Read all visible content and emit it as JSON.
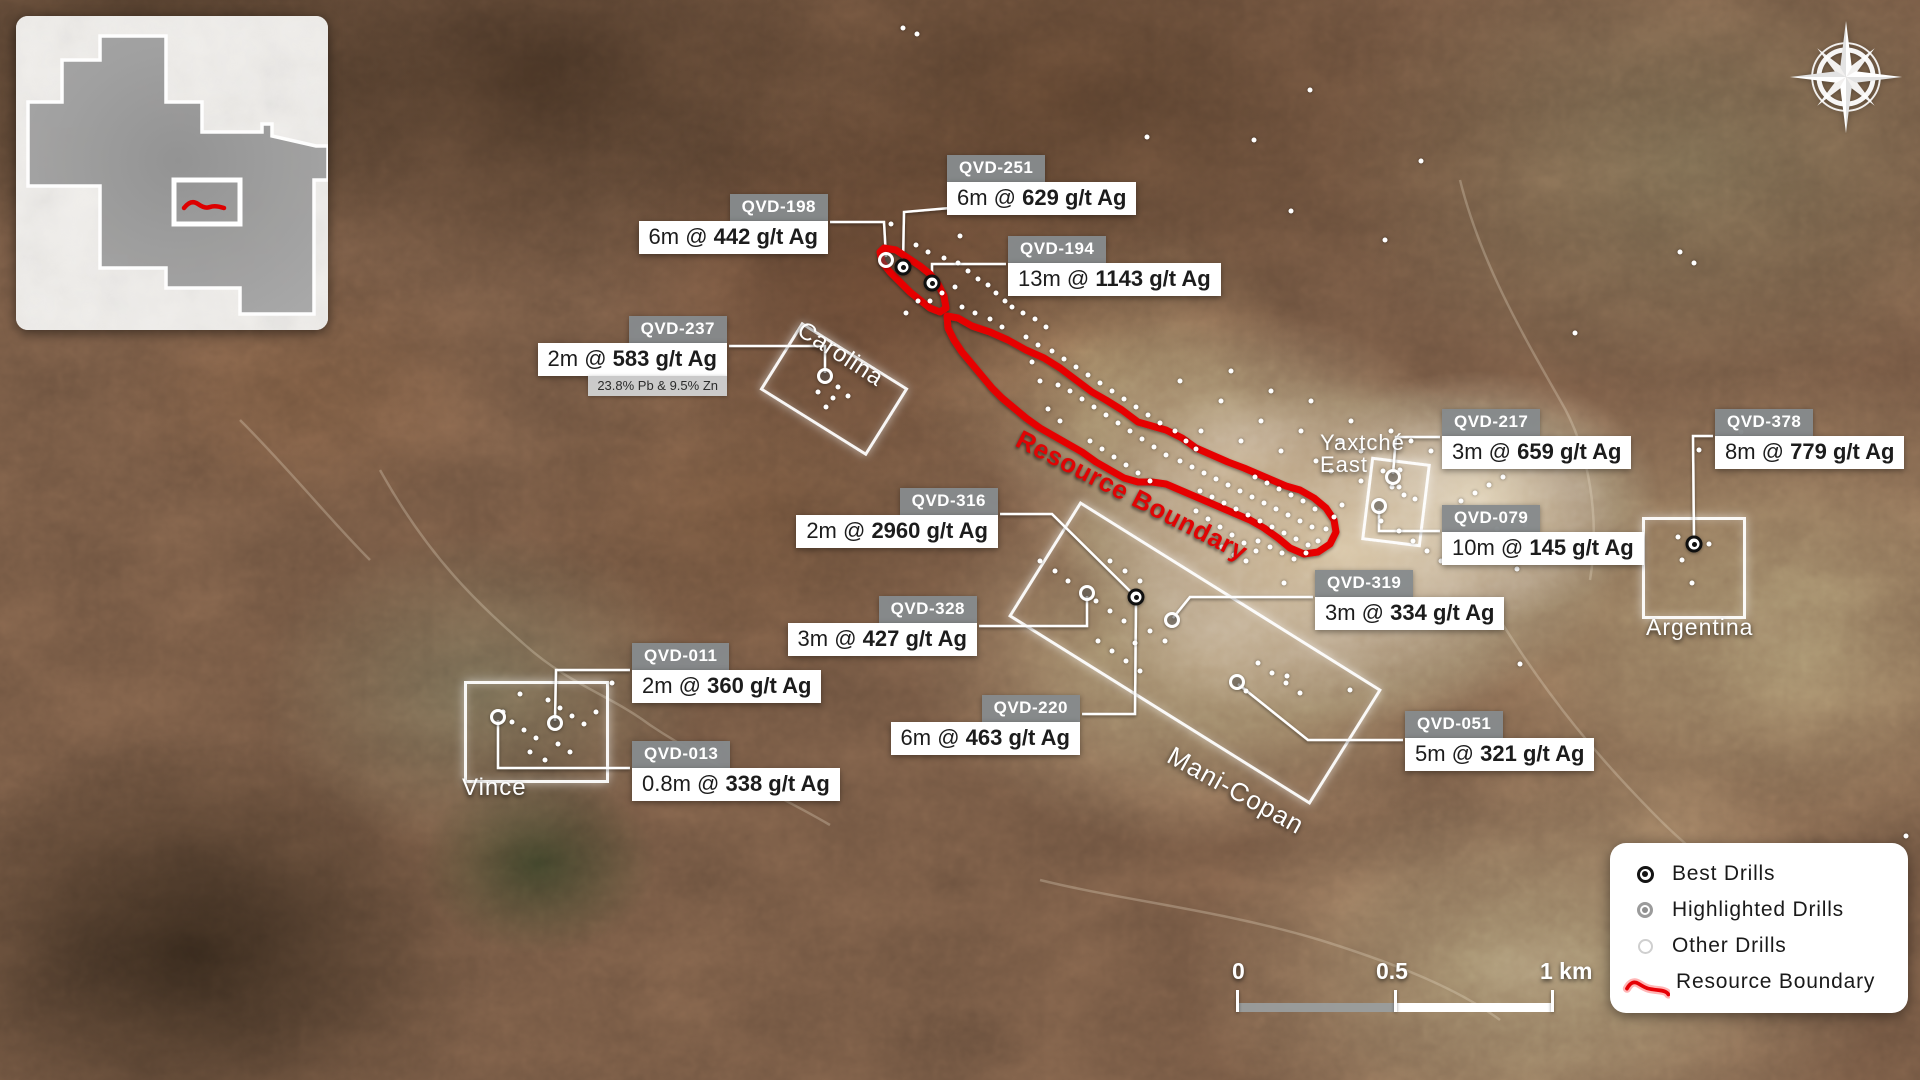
{
  "colors": {
    "boundary_red": "#e60005",
    "leader_white": "#ffffff",
    "chip_gray": "#868a8d",
    "legend_text": "#1a1a1a",
    "claim_gray": "#9c9c9c"
  },
  "inset": {
    "outline_path": "M84,20 L150,20 L150,86 L186,86 L186,116 L246,116 L246,108 L256,108 L256,120 L300,130 L312,130 L312,164 L298,164 L298,298 L224,298 L224,272 L150,272 L150,252 L84,252 L84,170 L12,170 L12,86 L46,86 L46,44 L84,44 Z",
    "marker_rect": {
      "x": 158,
      "y": 164,
      "w": 66,
      "h": 44
    },
    "marker_squiggle": "M168,192 q7,-9 14,-4 t12,3 t14,1"
  },
  "legend": {
    "squiggle": "M6,25 q6,-11 14,-6 t12,6 t13,2 t11,5",
    "items": [
      {
        "type": "best",
        "label": "Best Drills"
      },
      {
        "type": "highlighted",
        "label": "Highlighted Drills"
      },
      {
        "type": "other",
        "label": "Other Drills"
      },
      {
        "type": "boundary",
        "label": "Resource Boundary"
      }
    ]
  },
  "scalebar": {
    "labels": [
      {
        "text": "0",
        "x": 0
      },
      {
        "text": "0.5",
        "x": 144
      },
      {
        "text": "1 km",
        "x": 308
      }
    ]
  },
  "map": {
    "boundary_label": {
      "text": "Resource Boundary",
      "x": 1025,
      "y": 424,
      "rot": 27,
      "size": 26
    },
    "boundary_paths": {
      "main": "M947,316 L958,318 L972,326 L990,332 L1008,340 L1026,350 L1044,358 L1060,368 L1076,380 L1092,392 L1106,400 L1122,410 L1138,422 L1152,426 L1166,430 L1182,438 L1196,448 L1212,455 L1228,462 L1244,468 L1258,474 L1272,480 L1286,486 L1300,490 L1314,498 L1326,508 L1334,520 L1336,532 L1330,544 L1318,552 L1304,554 L1290,548 L1278,538 L1264,528 L1250,520 L1236,514 L1222,508 L1208,502 L1194,496 L1180,490 L1166,484 L1152,482 L1138,482 L1124,478 L1110,470 L1096,462 L1082,452 L1068,444 L1054,436 L1040,428 L1026,418 L1014,408 L1002,398 L992,388 L982,376 L972,364 L962,352 L954,340 L948,328 Z",
      "northwest": "M884,248 L896,250 L908,258 L920,266 L930,274 L938,284 L944,296 L946,308 L940,312 L930,308 L920,300 L910,292 L900,282 L890,272 L882,262 L880,252 Z"
    },
    "zones": [
      {
        "id": "carolina",
        "label": [
          "Carolina"
        ],
        "cx": 831,
        "cy": 386,
        "w": 120,
        "h": 74,
        "rot": 32,
        "lx": 806,
        "ly": 318,
        "lrot": 33,
        "lsize": 24
      },
      {
        "id": "vince",
        "label": [
          "Vince"
        ],
        "cx": 533,
        "cy": 729,
        "w": 139,
        "h": 96,
        "rot": 0,
        "lx": 462,
        "ly": 776,
        "lrot": 0,
        "lsize": 24
      },
      {
        "id": "mani-copan",
        "label": [
          "Mani-Copan"
        ],
        "cx": 1192,
        "cy": 650,
        "w": 350,
        "h": 130,
        "rot": 32,
        "lx": 1176,
        "ly": 742,
        "lrot": 29,
        "lsize": 26
      },
      {
        "id": "argentina",
        "label": [
          "Argentina"
        ],
        "cx": 1691,
        "cy": 565,
        "w": 98,
        "h": 96,
        "rot": 0,
        "lx": 1646,
        "ly": 616,
        "lrot": 0,
        "lsize": 23
      },
      {
        "id": "yaxtche-east",
        "label": [
          "Yaxtché",
          "East"
        ],
        "cx": 1393,
        "cy": 499,
        "w": 54,
        "h": 78,
        "rot": 7,
        "lx": 1320,
        "ly": 432,
        "lrot": 0,
        "lsize": 22
      }
    ],
    "callouts": [
      {
        "id": "qvd-251",
        "title": "QVD-251",
        "pre": "6m @ ",
        "val": "629 g/t Ag",
        "align": "left",
        "x": 947,
        "y": 155,
        "leader": [
          [
            950,
            208
          ],
          [
            904,
            212
          ],
          [
            903,
            264
          ]
        ]
      },
      {
        "id": "qvd-198",
        "title": "QVD-198",
        "pre": "6m @ ",
        "val": "442 g/t Ag",
        "align": "right",
        "x": 828,
        "y": 194,
        "leader": [
          [
            830,
            222
          ],
          [
            884,
            222
          ],
          [
            886,
            257
          ]
        ]
      },
      {
        "id": "qvd-194",
        "title": "QVD-194",
        "pre": "13m @ ",
        "val": "1143 g/t Ag",
        "align": "left",
        "x": 1008,
        "y": 236,
        "leader": [
          [
            1006,
            264
          ],
          [
            932,
            264
          ],
          [
            932,
            280
          ]
        ]
      },
      {
        "id": "qvd-237",
        "title": "QVD-237",
        "pre": "2m @ ",
        "val": "583 g/t Ag",
        "note": "23.8% Pb & 9.5% Zn",
        "align": "right",
        "x": 727,
        "y": 316,
        "leader": [
          [
            729,
            346
          ],
          [
            825,
            346
          ],
          [
            825,
            373
          ]
        ]
      },
      {
        "id": "qvd-217",
        "title": "QVD-217",
        "pre": "3m @ ",
        "val": "659 g/t Ag",
        "align": "left",
        "x": 1442,
        "y": 409,
        "leader": [
          [
            1440,
            437
          ],
          [
            1396,
            437
          ],
          [
            1393,
            474
          ]
        ]
      },
      {
        "id": "qvd-079",
        "title": "QVD-079",
        "pre": "10m @ ",
        "val": "145 g/t Ag",
        "align": "left",
        "x": 1442,
        "y": 505,
        "leader": [
          [
            1440,
            531
          ],
          [
            1379,
            531
          ],
          [
            1379,
            509
          ]
        ]
      },
      {
        "id": "qvd-378",
        "title": "QVD-378",
        "pre": "8m @ ",
        "val": "779 g/t Ag",
        "align": "left",
        "x": 1715,
        "y": 409,
        "leader": [
          [
            1713,
            436
          ],
          [
            1693,
            436
          ],
          [
            1694,
            541
          ]
        ]
      },
      {
        "id": "qvd-316",
        "title": "QVD-316",
        "pre": "2m @ ",
        "val": "2960 g/t Ag",
        "align": "right",
        "x": 998,
        "y": 488,
        "leader": [
          [
            1000,
            514
          ],
          [
            1052,
            514
          ],
          [
            1134,
            595
          ]
        ]
      },
      {
        "id": "qvd-328",
        "title": "QVD-328",
        "pre": "3m @ ",
        "val": "427 g/t Ag",
        "align": "right",
        "x": 977,
        "y": 596,
        "leader": [
          [
            979,
            626
          ],
          [
            1087,
            626
          ],
          [
            1087,
            596
          ]
        ]
      },
      {
        "id": "qvd-319",
        "title": "QVD-319",
        "pre": "3m @ ",
        "val": "334 g/t Ag",
        "align": "left",
        "x": 1315,
        "y": 570,
        "leader": [
          [
            1313,
            597
          ],
          [
            1190,
            597
          ],
          [
            1173,
            618
          ]
        ]
      },
      {
        "id": "qvd-011",
        "title": "QVD-011",
        "pre": "2m @ ",
        "val": "360 g/t Ag",
        "align": "left",
        "x": 632,
        "y": 643,
        "leader": [
          [
            630,
            670
          ],
          [
            556,
            670
          ],
          [
            555,
            721
          ]
        ]
      },
      {
        "id": "qvd-013",
        "title": "QVD-013",
        "pre": "0.8m @ ",
        "val": "338 g/t Ag",
        "align": "left",
        "x": 632,
        "y": 741,
        "leader": [
          [
            630,
            768
          ],
          [
            498,
            768
          ],
          [
            498,
            720
          ]
        ]
      },
      {
        "id": "qvd-220",
        "title": "QVD-220",
        "pre": "6m @ ",
        "val": "463 g/t Ag",
        "align": "right",
        "x": 1080,
        "y": 695,
        "leader": [
          [
            1082,
            714
          ],
          [
            1135,
            714
          ],
          [
            1136,
            600
          ]
        ]
      },
      {
        "id": "qvd-051",
        "title": "QVD-051",
        "pre": "5m @ ",
        "val": "321 g/t Ag",
        "align": "left",
        "x": 1405,
        "y": 711,
        "leader": [
          [
            1403,
            740
          ],
          [
            1308,
            740
          ],
          [
            1238,
            684
          ]
        ]
      }
    ],
    "best_drills": [
      [
        903,
        267
      ],
      [
        932,
        283
      ],
      [
        1136,
        597
      ],
      [
        1694,
        544
      ]
    ],
    "highlighted_drills": [
      [
        886,
        260
      ],
      [
        825,
        376
      ],
      [
        1393,
        477
      ],
      [
        1379,
        506
      ],
      [
        1087,
        593
      ],
      [
        1172,
        620
      ],
      [
        1237,
        682
      ],
      [
        555,
        723
      ],
      [
        498,
        717
      ]
    ],
    "other_drills": [
      [
        916,
        245
      ],
      [
        928,
        252
      ],
      [
        944,
        258
      ],
      [
        958,
        263
      ],
      [
        968,
        271
      ],
      [
        978,
        279
      ],
      [
        988,
        285
      ],
      [
        996,
        293
      ],
      [
        1005,
        301
      ],
      [
        955,
        287
      ],
      [
        942,
        293
      ],
      [
        930,
        301
      ],
      [
        962,
        307
      ],
      [
        975,
        313
      ],
      [
        990,
        319
      ],
      [
        1002,
        327
      ],
      [
        918,
        301
      ],
      [
        906,
        313
      ],
      [
        1012,
        307
      ],
      [
        1023,
        313
      ],
      [
        1035,
        319
      ],
      [
        1046,
        327
      ],
      [
        1012,
        291
      ],
      [
        960,
        236
      ],
      [
        891,
        224
      ],
      [
        1026,
        337
      ],
      [
        1038,
        345
      ],
      [
        1052,
        351
      ],
      [
        1064,
        359
      ],
      [
        1076,
        367
      ],
      [
        1088,
        375
      ],
      [
        1100,
        383
      ],
      [
        1112,
        391
      ],
      [
        1124,
        399
      ],
      [
        1136,
        407
      ],
      [
        1148,
        415
      ],
      [
        1160,
        423
      ],
      [
        1070,
        391
      ],
      [
        1082,
        399
      ],
      [
        1094,
        407
      ],
      [
        1106,
        415
      ],
      [
        1118,
        423
      ],
      [
        1130,
        431
      ],
      [
        1142,
        439
      ],
      [
        1154,
        447
      ],
      [
        1166,
        455
      ],
      [
        1060,
        421
      ],
      [
        1048,
        409
      ],
      [
        1040,
        381
      ],
      [
        1090,
        441
      ],
      [
        1102,
        449
      ],
      [
        1114,
        457
      ],
      [
        1126,
        465
      ],
      [
        1138,
        473
      ],
      [
        1150,
        481
      ],
      [
        1175,
        431
      ],
      [
        1186,
        441
      ],
      [
        1196,
        449
      ],
      [
        1058,
        385
      ],
      [
        1032,
        362
      ],
      [
        1180,
        461
      ],
      [
        1192,
        467
      ],
      [
        1204,
        473
      ],
      [
        1216,
        479
      ],
      [
        1228,
        485
      ],
      [
        1240,
        491
      ],
      [
        1252,
        497
      ],
      [
        1264,
        503
      ],
      [
        1276,
        509
      ],
      [
        1288,
        515
      ],
      [
        1300,
        521
      ],
      [
        1312,
        527
      ],
      [
        1200,
        491
      ],
      [
        1212,
        497
      ],
      [
        1224,
        503
      ],
      [
        1236,
        509
      ],
      [
        1248,
        515
      ],
      [
        1260,
        521
      ],
      [
        1272,
        527
      ],
      [
        1284,
        533
      ],
      [
        1296,
        539
      ],
      [
        1308,
        545
      ],
      [
        1196,
        511
      ],
      [
        1208,
        519
      ],
      [
        1220,
        527
      ],
      [
        1232,
        535
      ],
      [
        1244,
        543
      ],
      [
        1256,
        551
      ],
      [
        1222,
        547
      ],
      [
        1234,
        555
      ],
      [
        1246,
        561
      ],
      [
        1258,
        541
      ],
      [
        1270,
        547
      ],
      [
        1282,
        553
      ],
      [
        1294,
        559
      ],
      [
        1306,
        553
      ],
      [
        1318,
        541
      ],
      [
        1326,
        529
      ],
      [
        1334,
        517
      ],
      [
        1342,
        505
      ],
      [
        1255,
        477
      ],
      [
        1267,
        483
      ],
      [
        1279,
        489
      ],
      [
        1291,
        495
      ],
      [
        1303,
        501
      ],
      [
        1315,
        509
      ],
      [
        1180,
        381
      ],
      [
        1221,
        401
      ],
      [
        1261,
        421
      ],
      [
        1301,
        431
      ],
      [
        1341,
        441
      ],
      [
        1361,
        451
      ],
      [
        1241,
        441
      ],
      [
        1281,
        451
      ],
      [
        1201,
        431
      ],
      [
        1231,
        371
      ],
      [
        1271,
        391
      ],
      [
        1311,
        401
      ],
      [
        1351,
        421
      ],
      [
        1391,
        431
      ],
      [
        1411,
        441
      ],
      [
        1431,
        451
      ],
      [
        1383,
        471
      ],
      [
        1399,
        487
      ],
      [
        1415,
        499
      ],
      [
        1361,
        481
      ],
      [
        1331,
        471
      ],
      [
        1400,
        470
      ],
      [
        1392,
        487
      ],
      [
        1404,
        495
      ],
      [
        1381,
        521
      ],
      [
        1399,
        531
      ],
      [
        1413,
        541
      ],
      [
        1427,
        551
      ],
      [
        1441,
        561
      ],
      [
        1455,
        553
      ],
      [
        1469,
        545
      ],
      [
        1483,
        537
      ],
      [
        1497,
        529
      ],
      [
        1461,
        501
      ],
      [
        1475,
        493
      ],
      [
        1489,
        485
      ],
      [
        1503,
        477
      ],
      [
        1517,
        569
      ],
      [
        1531,
        557
      ],
      [
        1511,
        541
      ],
      [
        1525,
        525
      ],
      [
        1316,
        461
      ],
      [
        903,
        28
      ],
      [
        917,
        34
      ],
      [
        1147,
        137
      ],
      [
        1254,
        140
      ],
      [
        1291,
        211
      ],
      [
        1385,
        240
      ],
      [
        1421,
        161
      ],
      [
        1575,
        333
      ],
      [
        1680,
        252
      ],
      [
        1694,
        263
      ],
      [
        1741,
        432
      ],
      [
        1310,
        90
      ],
      [
        1906,
        836
      ],
      [
        503,
        712
      ],
      [
        512,
        722
      ],
      [
        524,
        730
      ],
      [
        536,
        738
      ],
      [
        548,
        700
      ],
      [
        560,
        708
      ],
      [
        572,
        716
      ],
      [
        584,
        724
      ],
      [
        530,
        752
      ],
      [
        545,
        760
      ],
      [
        558,
        744
      ],
      [
        570,
        752
      ],
      [
        596,
        712
      ],
      [
        520,
        694
      ],
      [
        612,
        683
      ],
      [
        806,
        686
      ],
      [
        818,
        392
      ],
      [
        833,
        398
      ],
      [
        838,
        387
      ],
      [
        848,
        396
      ],
      [
        826,
        407
      ],
      [
        1040,
        561
      ],
      [
        1055,
        571
      ],
      [
        1068,
        581
      ],
      [
        1096,
        601
      ],
      [
        1110,
        611
      ],
      [
        1124,
        621
      ],
      [
        1150,
        631
      ],
      [
        1165,
        641
      ],
      [
        1110,
        561
      ],
      [
        1125,
        571
      ],
      [
        1140,
        581
      ],
      [
        1098,
        641
      ],
      [
        1112,
        651
      ],
      [
        1126,
        661
      ],
      [
        1140,
        671
      ],
      [
        1258,
        663
      ],
      [
        1272,
        673
      ],
      [
        1286,
        683
      ],
      [
        1300,
        693
      ],
      [
        1246,
        691
      ],
      [
        1135,
        643
      ],
      [
        1284,
        583
      ],
      [
        1287,
        676
      ],
      [
        1350,
        690
      ],
      [
        1678,
        537
      ],
      [
        1682,
        560
      ],
      [
        1692,
        583
      ],
      [
        1709,
        544
      ],
      [
        1699,
        450
      ],
      [
        1520,
        664
      ]
    ]
  }
}
